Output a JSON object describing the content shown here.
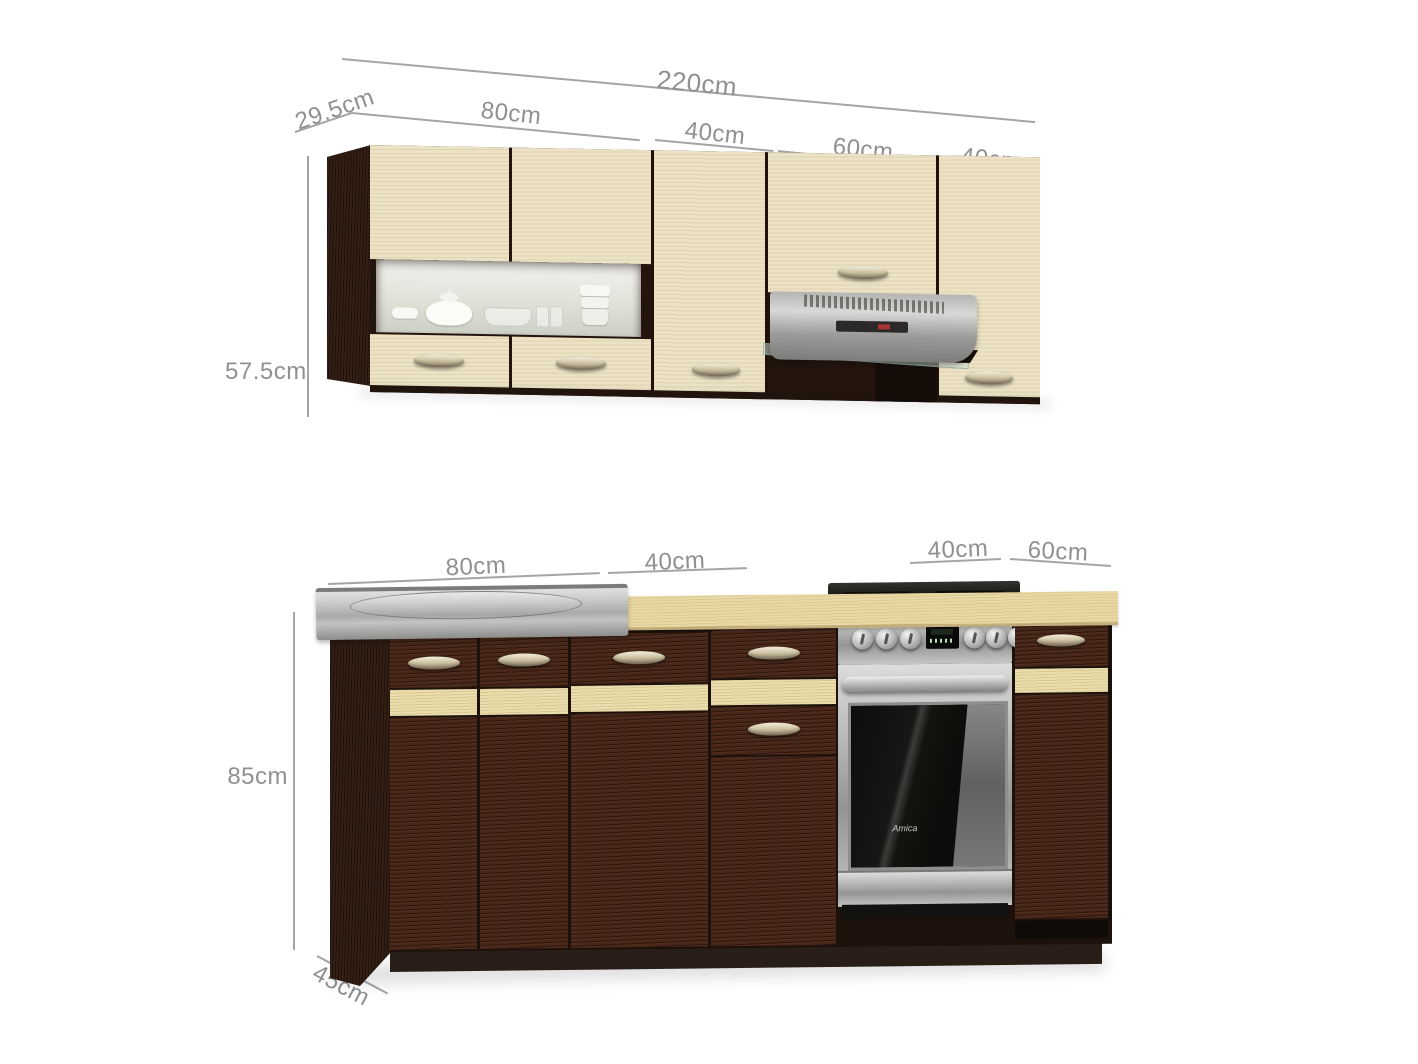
{
  "annotations": {
    "top": {
      "total": "220cm",
      "depth": "29.5cm",
      "height": "57.5cm",
      "seg1": "80cm",
      "seg2": "40cm",
      "seg3": "60cm",
      "seg4": "40cm"
    },
    "bottom": {
      "height": "85cm",
      "depth": "45cm",
      "seg1": "80cm",
      "seg2": "40cm",
      "seg3": "40cm",
      "seg4": "60cm"
    }
  },
  "appliances": {
    "stove_brand": "Amica"
  },
  "colors": {
    "dimension_text": "#8f9093",
    "cream_front": "#ece3c6",
    "wenge_front": "#48281a",
    "beech_counter": "#e9d9a6",
    "stainless": "#b9b9b7",
    "accent_stripe": "#eaddae"
  }
}
